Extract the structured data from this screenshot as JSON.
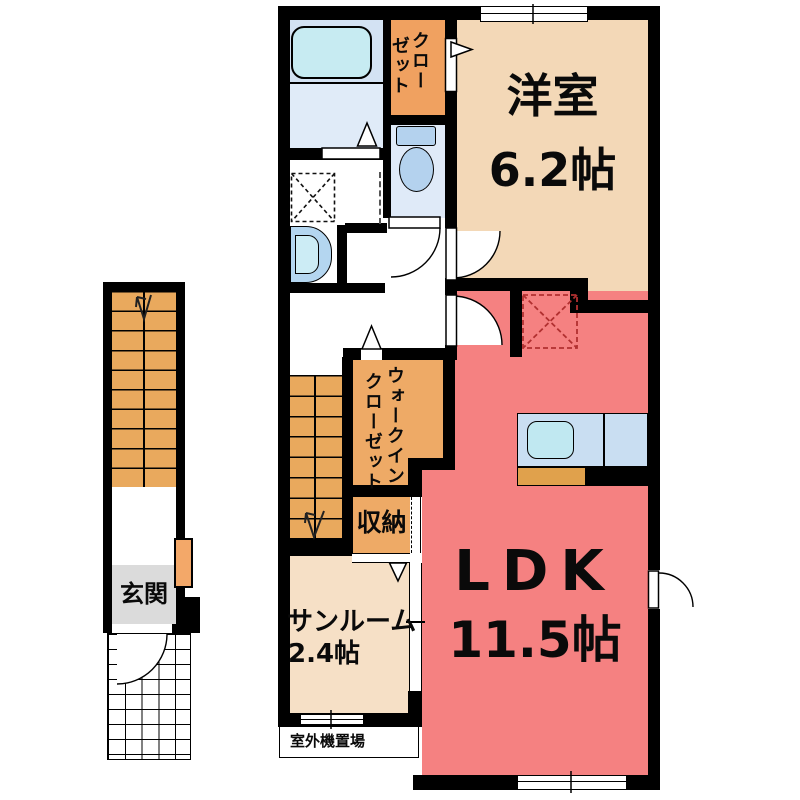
{
  "title": "2F apartment floor plan",
  "colors": {
    "wall": "#000000",
    "western": "#f3d8b7",
    "ldk": "#f58181",
    "closet": "#f0a160",
    "wic": "#eeaa66",
    "storage": "#eeaa66",
    "stairs": "#e9a95d",
    "sunroom": "#f6e0c6",
    "bathUpper": "#d3e2f3",
    "bathLower": "#e0ebf8",
    "tub": "#c7ebf2",
    "toiletRoom": "#dfeaf8",
    "fixture": "#b4d2ee",
    "vanityOuter": "#b4d6f0",
    "vanityInner": "#ccecf5",
    "counter": "#c9def2",
    "sink": "#c0e8f1",
    "counterBlock": "#e0a14c",
    "genkan": "#dbdbdb",
    "doorPanel": "#f3a869",
    "fridgeDash": "#b13030"
  },
  "rooms": {
    "western": {
      "name": "洋室",
      "size": "6.2帖"
    },
    "ldk": {
      "name": "LDK",
      "size": "11.5帖"
    },
    "sunroom": {
      "name": "サンルーム",
      "size": "2.4帖"
    },
    "closet": {
      "line1": "クロー",
      "line2": "ゼット"
    },
    "wic": {
      "line1": "ウォークイン",
      "line2": "クローゼット"
    },
    "storage": {
      "name": "収納"
    },
    "entrance": {
      "name": "玄関"
    },
    "outdoor_unit": {
      "name": "室外機置場"
    }
  }
}
